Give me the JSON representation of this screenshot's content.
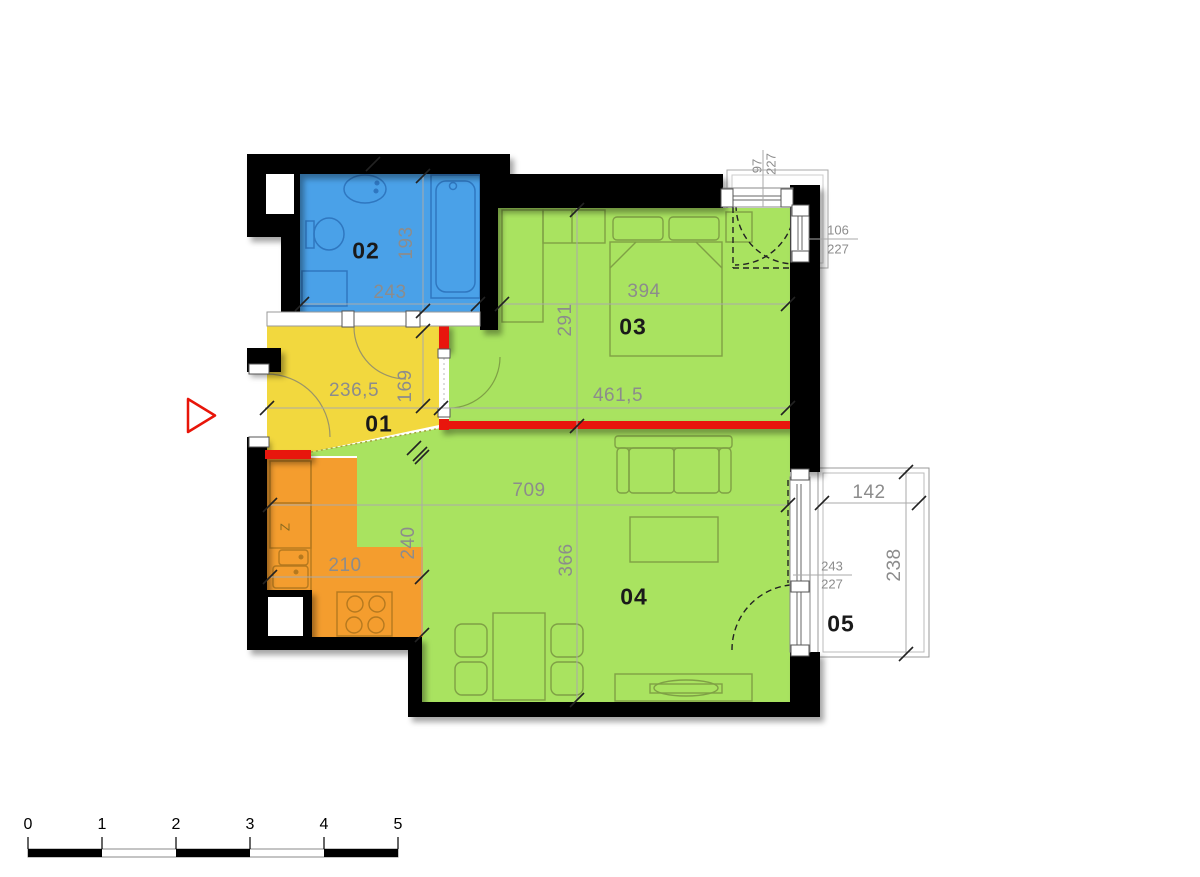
{
  "plan": {
    "rooms": {
      "r01": "01",
      "r02": "02",
      "r03": "03",
      "r04": "04",
      "r05": "05"
    },
    "dims": {
      "bath_w": "243",
      "bath_d": "193",
      "bed_w1": "394",
      "bed_d": "291",
      "bed_w2": "461,5",
      "hall_w": "236,5",
      "hall_d": "169",
      "living_w": "709",
      "living_d": "366",
      "kitchen_w": "210",
      "kitchen_d": "240",
      "balcony_w": "142",
      "balcony_d": "238"
    },
    "openings": {
      "balcony_door_w": "243",
      "balcony_door_h": "227",
      "top_window_w": "97",
      "top_window_h": "227",
      "side_window_w": "106",
      "side_window_h": "227"
    },
    "kitchen_mark": "Z",
    "scale_bar": {
      "t0": "0",
      "t1": "1",
      "t2": "2",
      "t3": "3",
      "t4": "4",
      "t5": "5"
    },
    "colors": {
      "bathroom": "#4aa1e8",
      "hall": "#f2d83e",
      "room_green": "#a9e360",
      "kitchen": "#f49d2e",
      "new_wall_red": "#e81509",
      "wall": "#000000",
      "dim_text": "#8c8c8c"
    }
  }
}
